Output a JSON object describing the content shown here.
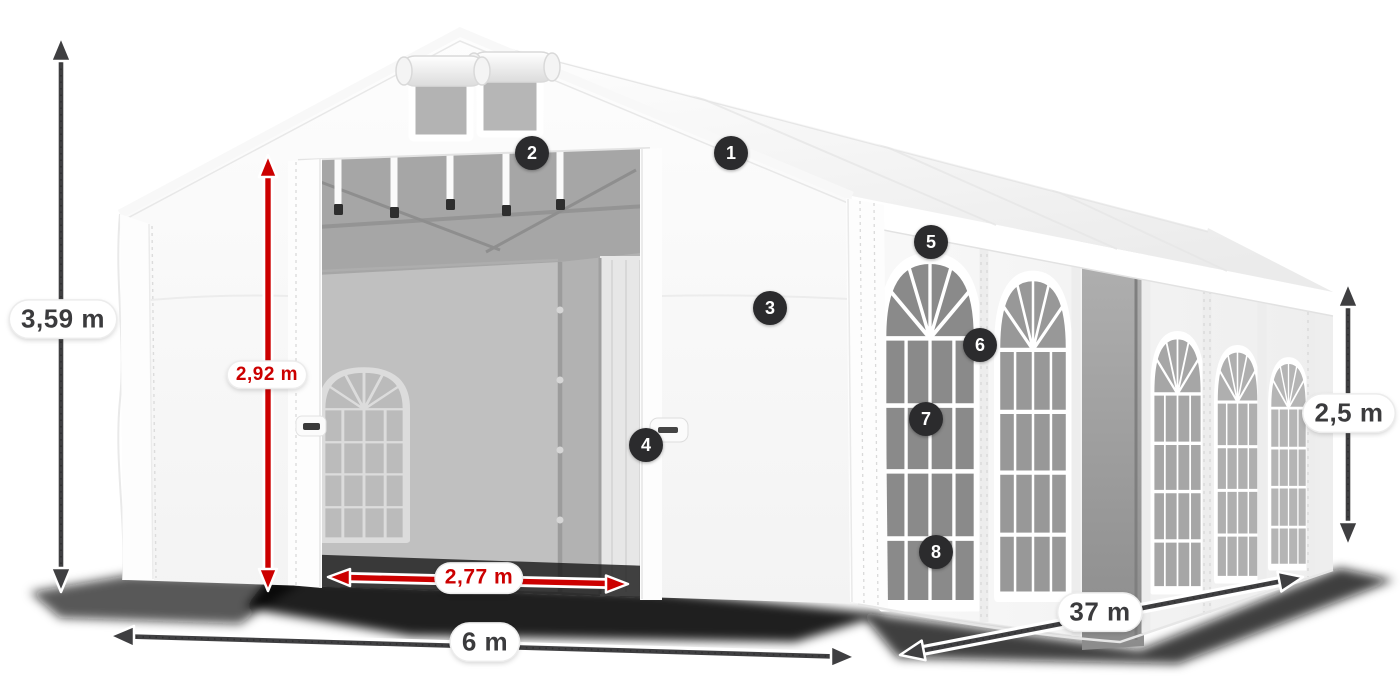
{
  "illustration": {
    "name": "party-tent-dimensions-diagram",
    "subject": "White marquee tent with open front entrance, three-quarter view",
    "colors": {
      "dimension_arrow_dark": "#3f3f41",
      "dimension_arrow_red": "#cc0000",
      "badge_background": "#2b2b2d",
      "badge_text": "#ffffff",
      "label_background": "#ffffff",
      "label_text_dark": "#3b3b3d",
      "label_text_red": "#cc0000"
    }
  },
  "measurements": {
    "total_height": "3,59 m",
    "entrance_height": "2,92 m",
    "entrance_width": "2,77 m",
    "front_width": "6 m",
    "side_length": "37 m",
    "side_wall_height": "2,5 m"
  },
  "badges": [
    "1",
    "2",
    "3",
    "4",
    "5",
    "6",
    "7",
    "8"
  ]
}
